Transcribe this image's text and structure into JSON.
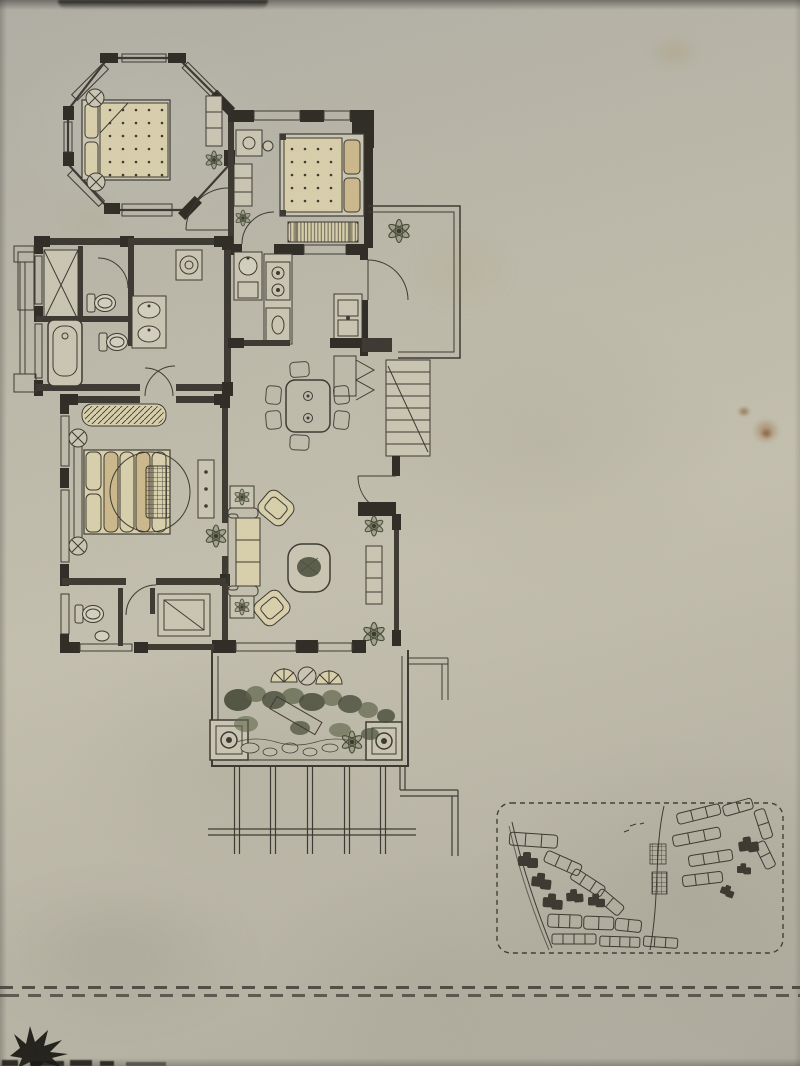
{
  "page": {
    "kind": "photograph of a hand-drawn residential floor plan on aged paper",
    "visible_text": "none"
  },
  "colors": {
    "ink": "#34312a",
    "wall_black": "#26231d",
    "paper_light": "#cdc9b6",
    "furniture_cream": "#ddd3ae",
    "furniture_tan": "#cfba8c",
    "foliage_mid": "#5a6045",
    "foliage_dark": "#3f4431",
    "stain_brown": "#8a5a28"
  },
  "floor_plan": {
    "rooms": [
      {
        "name": "bay-window-bedroom",
        "shape": "octagonal bay",
        "furniture": [
          "double-bed-dotted-mattress",
          "two-round-side-tables",
          "tall-cabinet",
          "plant"
        ]
      },
      {
        "name": "bedroom-2",
        "furniture": [
          "double-bed-tan",
          "foot-bench",
          "dressing-table",
          "shelf-cabinet",
          "plant"
        ]
      },
      {
        "name": "entry-porch",
        "furniture": [
          "potted-plant",
          "entry-door-arc",
          "step"
        ]
      },
      {
        "name": "closet",
        "furniture": [
          "wardrobe-x"
        ]
      },
      {
        "name": "bathroom-upper",
        "furniture": [
          "toilet",
          "door-arc",
          "double-basin-vanity"
        ]
      },
      {
        "name": "bathroom-lower",
        "furniture": [
          "bathtub",
          "toilet"
        ]
      },
      {
        "name": "laundry-corner",
        "furniture": [
          "washing-machine"
        ]
      },
      {
        "name": "kitchen",
        "furniture": [
          "round-sink",
          "two-burner-stove",
          "base-cabinet",
          "double-sink-unit"
        ]
      },
      {
        "name": "dining-area",
        "furniture": [
          "table-for-six"
        ]
      },
      {
        "name": "hall",
        "furniture": [
          "shoe-cabinet",
          "break-line-symbol",
          "exterior-stairs"
        ]
      },
      {
        "name": "master-bedroom",
        "furniture": [
          "double-bed-striped-duvet",
          "round-rug",
          "textured-mat",
          "bench",
          "dresser",
          "plant",
          "two-round-side-tables"
        ]
      },
      {
        "name": "powder-room",
        "furniture": [
          "toilet",
          "basin"
        ]
      },
      {
        "name": "storage-room",
        "furniture": [
          "cabinet-with-diagonal"
        ]
      },
      {
        "name": "living-room",
        "furniture": [
          "three-seat-sofa",
          "two-angled-armchairs",
          "two-side-tables-with-plants",
          "coffee-table-with-plant",
          "tv-cabinet",
          "two-plants"
        ]
      },
      {
        "name": "garden-terrace",
        "furniture": [
          "two-fan-back-chairs",
          "round-table",
          "shrub-border",
          "rock-garden",
          "stone-path",
          "two-corner-planters",
          "flower-wheel"
        ]
      },
      {
        "name": "pergola-fence",
        "elements": [
          "five-double-posts",
          "double-rail",
          "l-shaped-rail"
        ]
      }
    ]
  },
  "site_plan_inset": {
    "border": "dashed rounded rectangle",
    "roads": 2,
    "outlined_building_rows": 17,
    "highlighted_black_clusters": 8,
    "hatched_blocks": 2
  },
  "footer": {
    "divider": "double dashed horizontal line",
    "corner_mark": "black leaf-starburst silhouette",
    "bottom_edge_marks": 5
  },
  "photo_artifacts": {
    "stains": [
      "brown spot right-middle",
      "brown blotch right-middle",
      "faint tan smudge top-right",
      "pale blotches near plan"
    ],
    "shadows": [
      "dark strip along top edge",
      "left page edge",
      "soft vignette"
    ]
  }
}
